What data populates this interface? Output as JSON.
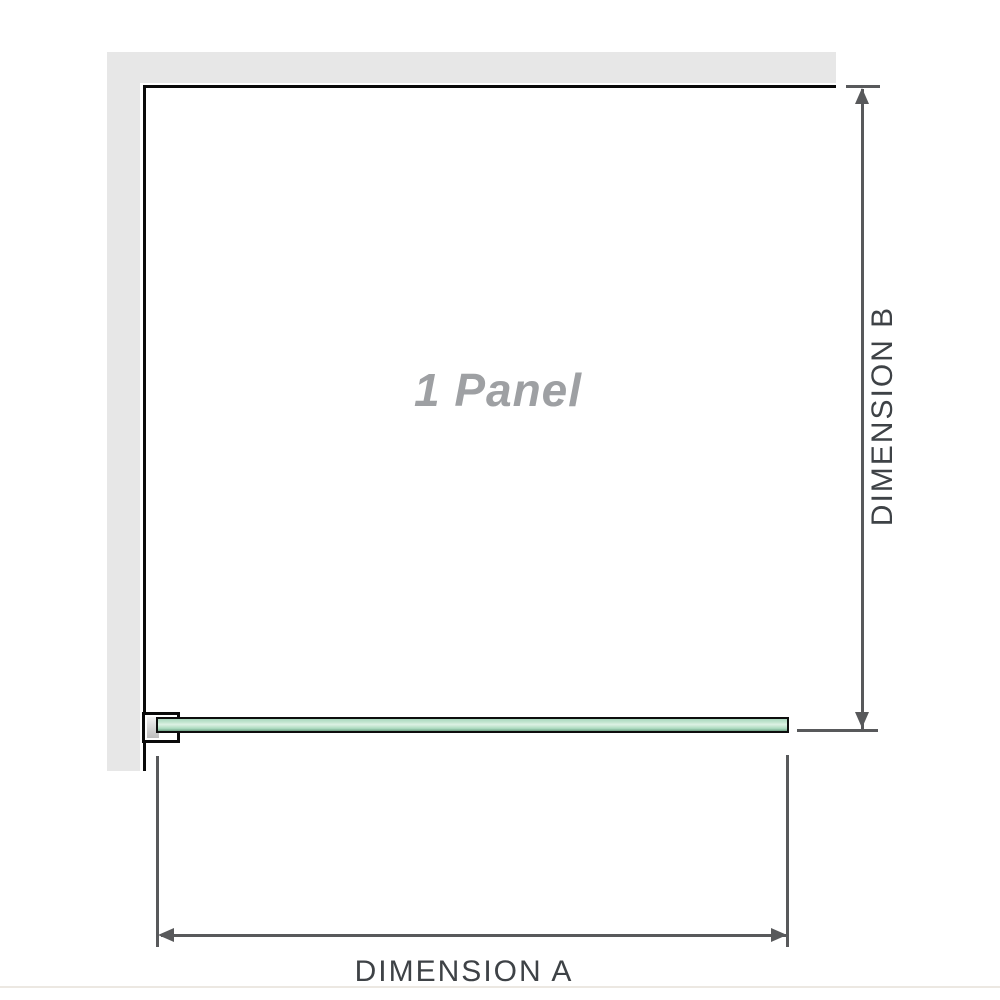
{
  "diagram": {
    "panel_label": "1 Panel",
    "dimension_a": {
      "label": "DIMENSION A"
    },
    "dimension_b": {
      "label": "DIMENSION B"
    }
  },
  "colors": {
    "wall": "#e7e7e7",
    "outline": "#0a0a0a",
    "dim-line": "#58595b",
    "dim-text": "#3e4246",
    "panel-text": "#9ea0a3",
    "glass-border": "#0d0d0d",
    "glass-light": "#ddf1e4",
    "glass-mid": "#a9d8bd",
    "glass-dark": "#6fa184",
    "baseline": "#ece8e2"
  }
}
